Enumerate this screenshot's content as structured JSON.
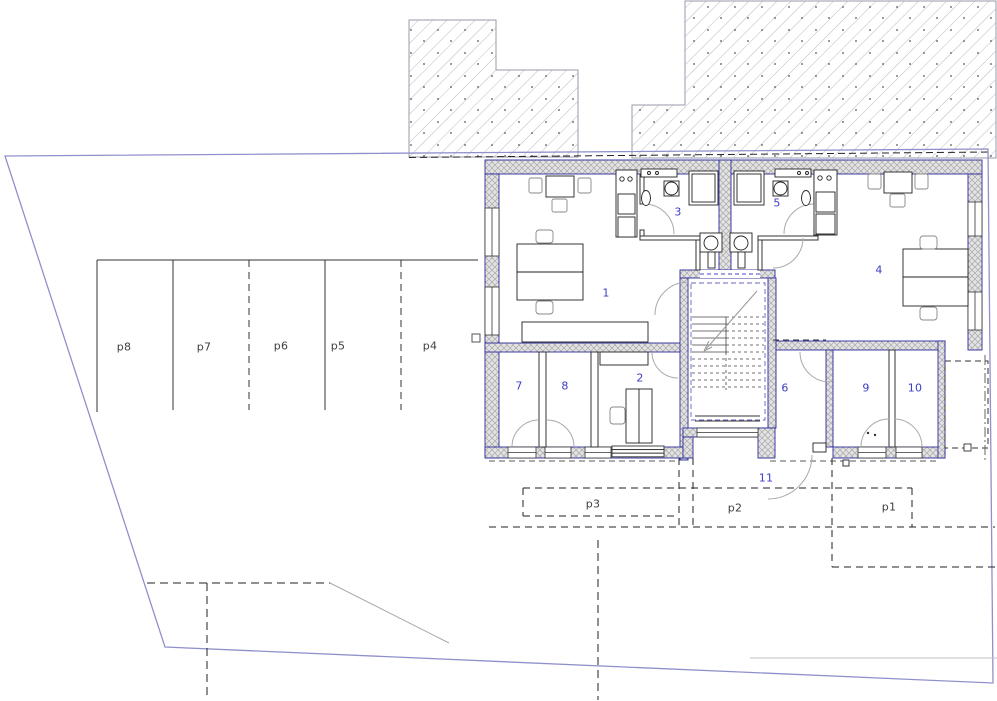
{
  "plan": {
    "title": "ground-floor-plan",
    "rooms": [
      {
        "label": "1"
      },
      {
        "label": "2"
      },
      {
        "label": "3"
      },
      {
        "label": "4"
      },
      {
        "label": "5"
      },
      {
        "label": "6"
      },
      {
        "label": "7"
      },
      {
        "label": "8"
      },
      {
        "label": "9"
      },
      {
        "label": "10"
      },
      {
        "label": "11"
      }
    ],
    "parking": [
      {
        "label": "p1"
      },
      {
        "label": "p2"
      },
      {
        "label": "p3"
      },
      {
        "label": "p4"
      },
      {
        "label": "p5"
      },
      {
        "label": "p6"
      },
      {
        "label": "p7"
      },
      {
        "label": "p8"
      }
    ],
    "colors": {
      "room_label": "#3c3cc8",
      "parking_label": "#3f3f3f",
      "site_boundary": "#9090cc",
      "wall_outline": "#2a2a99",
      "wall_hatch": "#a8a8a8",
      "neighbor_hatch": "#b9b9c4",
      "line": "#1a1a1a",
      "door_arc": "#aaaaaa"
    }
  }
}
